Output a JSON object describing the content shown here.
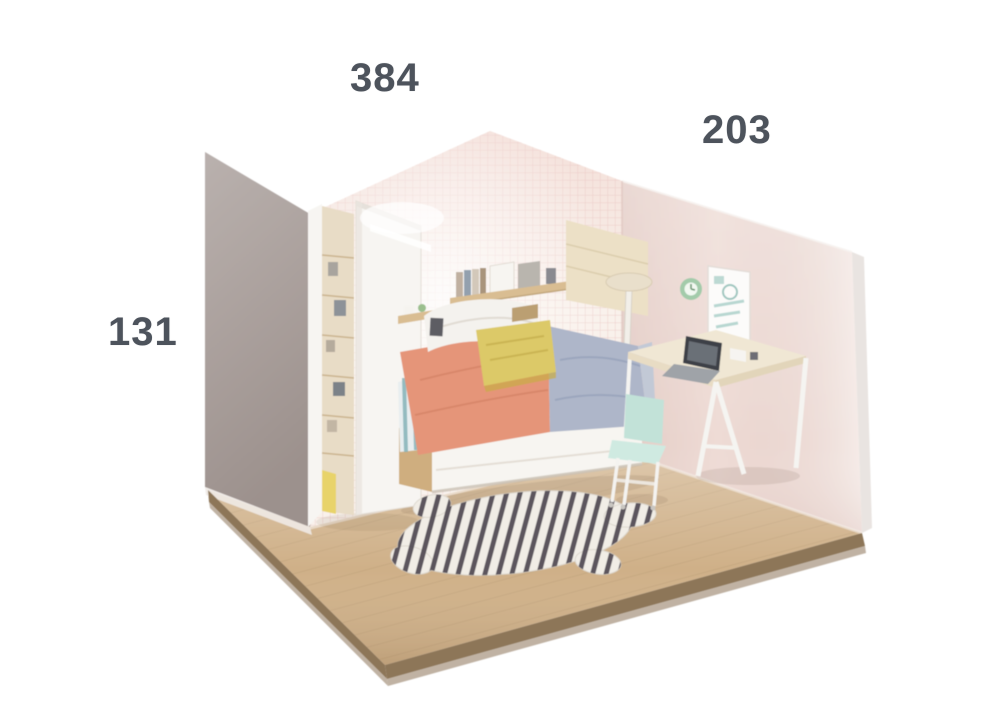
{
  "scene": {
    "description": "Cutaway 3D room illustration of a kids bedroom with dimension labels",
    "furniture": [
      "wardrobe",
      "wall-shelf",
      "bed-with-drawer",
      "headboard-panel",
      "stool",
      "wall-clock",
      "poster",
      "desk",
      "laptop",
      "desk-chair",
      "zebra-rug"
    ]
  },
  "dimension_labels": {
    "top": "384",
    "right": "203",
    "left": "131"
  },
  "colors": {
    "background": "#ffffff",
    "label_text": "#4d535c",
    "left_wall": "#a69b97",
    "wallpaper_base": "#f9f1eb",
    "wallpaper_grid": "#e9c6c2",
    "right_wall": "#eedbd5",
    "right_wall_edge": "#e9e4e1",
    "floor": "#cfb088",
    "floor_edge": "#8d7659",
    "floor_edge_lower": "#b5a593",
    "wardrobe_white": "#f7f5f2",
    "wardrobe_interior": "#e8dcc6",
    "wardrobe_accent_yellow": "#e8d36a",
    "shelf_wood": "#d9bd92",
    "headboard_panel": "#ece0c6",
    "stool_seat": "#e9dfcb",
    "clock_green": "#a3cbaa",
    "poster_white": "#fcfbfa",
    "bed_coral": "#e59579",
    "bed_lilac": "#aeb6c9",
    "bed_stripe_teal": "#7fafb5",
    "pillow_yellow": "#dcc967",
    "bed_white": "#f7f5f1",
    "bed_wood_base": "#cfae7f",
    "cushion_white": "#f4f2ee",
    "desk_top": "#f0e7d4",
    "desk_leg_white": "#f5f4f1",
    "chair_mint": "#c2e2d8",
    "laptop_dark": "#3e4046",
    "rug_base": "#f1ede6",
    "rug_stripe": "#47404a"
  }
}
